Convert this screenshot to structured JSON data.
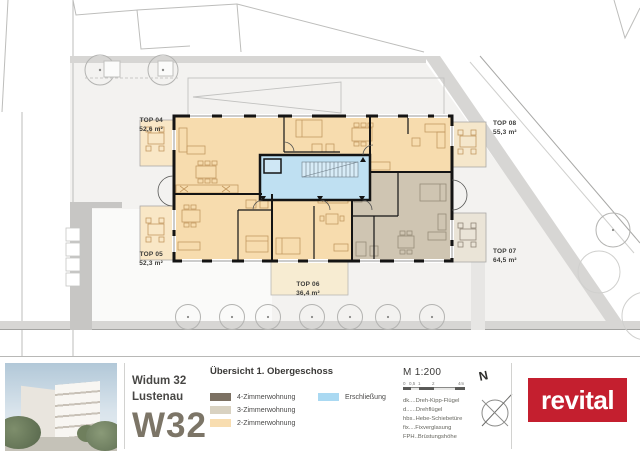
{
  "plan": {
    "units": {
      "top04": {
        "name": "TOP 04",
        "area": "52,6 m²"
      },
      "top05": {
        "name": "TOP 05",
        "area": "52,3 m²"
      },
      "top06": {
        "name": "TOP 06",
        "area": "36,4 m²"
      },
      "top07": {
        "name": "TOP 07",
        "area": "64,5 m²"
      },
      "top08": {
        "name": "TOP 08",
        "area": "55,3 m²"
      }
    },
    "zone_colors": {
      "apartment_2zi": "#f7dcae",
      "apartment_3zi": "#cfc5b2",
      "circulation": "#bfe0f2"
    }
  },
  "footer": {
    "project": {
      "line1": "Widum 32",
      "line2": "Lustenau",
      "code": "W32"
    },
    "title": "Übersicht 1. Obergeschoss",
    "legend": {
      "item1": {
        "label": "4-Zimmerwohnung",
        "color": "#7c7163"
      },
      "item2": {
        "label": "3-Zimmerwohnung",
        "color": "#d9d2c1"
      },
      "item3": {
        "label": "2-Zimmerwohnung",
        "color": "#f8ddb0"
      },
      "item4": {
        "label": "Erschließung",
        "color": "#aad9f2"
      }
    },
    "scale": {
      "label": "M 1:200",
      "ticks": {
        "t0": "0",
        "t1": "0,5",
        "t2": "1",
        "t3": "2",
        "t4": "4m"
      }
    },
    "abbreviations": {
      "line1": "dk....Dreh-Kipp-Flügel",
      "line2": "d......Drehflügel",
      "line3": "hbs..Hebe-Schiebetüre",
      "line4": "fix....Fixverglasung",
      "line5": "FPH..Brüstungshöhe"
    },
    "north": "N",
    "brand": "revital",
    "brand_color": "#c41f2f"
  }
}
